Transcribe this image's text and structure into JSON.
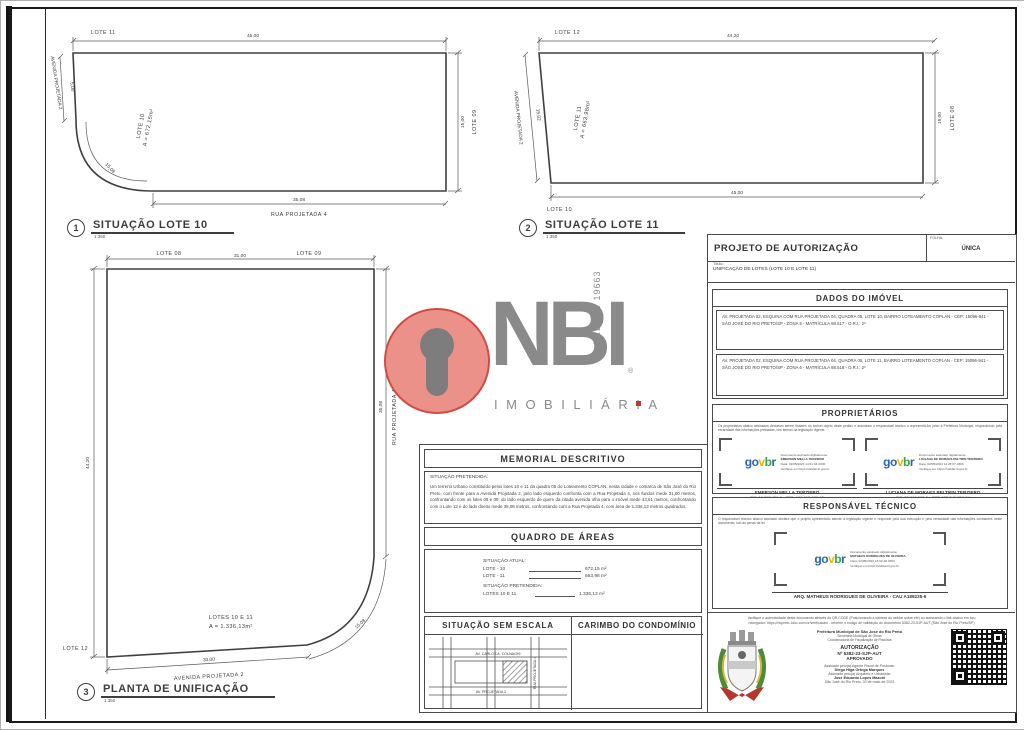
{
  "drawings": {
    "lote10": {
      "title_number": "1",
      "title": "SITUAÇÃO LOTE 10",
      "scale": "1:350",
      "top_label": "LOTE 11",
      "top_dim": "45,00",
      "left_street": "AVENIDA PROJETADA 2",
      "left_dim": "5,00",
      "curve_dim": "15,08",
      "inner_label": "LOTE 10",
      "inner_area": "A = 672,15m²",
      "right_label": "LOTE 09",
      "right_dim": "15,00",
      "bottom_dim": "35,08",
      "bottom_street": "RUA PROJETADA 4"
    },
    "lote11": {
      "title_number": "2",
      "title": "SITUAÇÃO LOTE 11",
      "scale": "1:350",
      "top_label": "LOTE 12",
      "top_dim": "44,20",
      "left_street": "AVENIDA PROJETADA 2",
      "left_dim": "15,02",
      "inner_label": "LOTE 11",
      "inner_area": "A = 663,98m²",
      "right_label": "LOTE 08",
      "right_dim": "15,00",
      "bottom_dim": "45,00",
      "bottom_label": "LOTE 10"
    },
    "unificacao": {
      "title_number": "3",
      "title": "PLANTA DE UNIFICAÇÃO",
      "scale": "1:350",
      "top_label_left": "LOTE 08",
      "top_label_right": "LOTE 09",
      "top_dim": "31,00",
      "left_dim": "44,20",
      "right_street": "RUA PROJETADA 4",
      "right_dim": "35,08",
      "curve_dim": "15,08",
      "inner_label": "LOTES 10 E 11",
      "inner_area": "A = 1.336,13m²",
      "left_label": "LOTE 12",
      "bottom_dim": "30,00",
      "bottom_street": "AVENIDA PROJETADA 2"
    }
  },
  "memorial": {
    "title": "MEMORIAL DESCRITIVO",
    "situation_label": "SITUAÇÃO PRETENDIDA:",
    "body": "Um terreno Urbano constituído pelos lotes 10 e 11 da quadra 05 do Loteamento COPLAN, nesta cidade e comarca de São José do Rio Preto, com frente para a Avenida Projetada 2, pelo lado esquerdo confronta com a Rua Projetada 4, nos fundos mede 31,00 metros, confrontando com os lotes 08 e 09; do lado esquerdo de quem da citada avenida olha para o imóvel mede 43,61 metros, confrontando com o Lote 12 e do lado direito mede 35,08 metros, confrontando com a Rua Projetada 4, com área de 1.336,13 metros quadrados."
  },
  "quadro": {
    "title": "QUADRO DE ÁREAS",
    "atual_label": "SITUAÇÃO ATUAL:",
    "rows": [
      {
        "label": "LOTE - 10",
        "value": "672,15 m²"
      },
      {
        "label": "LOTE - 11",
        "value": "663,98 m²"
      }
    ],
    "pretendida_label": "SITUAÇÃO PRETENDIDA:",
    "total_row": {
      "label": "LOTES 10 E 11",
      "value": "1.336,13 m²"
    }
  },
  "sem_escala": {
    "title": "SITUAÇÃO SEM ESCALA",
    "map": {
      "top_street": "AV. CARLOS A. COLNAGHI",
      "bottom_street": "AV. PROJETADA 2",
      "right_street": "RUA PROJETADA 4"
    }
  },
  "carimbo": {
    "title": "CARIMBO DO CONDOMÍNIO"
  },
  "projeto": {
    "title": "PROJETO DE AUTORIZAÇÃO",
    "folha_label": "FOLHA:",
    "folha_value": "ÚNICA",
    "titulo_label": "Título:",
    "titulo_value": "UNIFICAÇÃO DE LOTES (LOTE 10 E LOTE 11)"
  },
  "dados_imovel": {
    "title": "DADOS DO IMÓVEL",
    "lote10": "AV. PROJETADA 02, ESQUINA COM RUA PROJETADA 04, QUADRA 05, LOTE 10, BAIRRO LOTEAMENTO COPLAN - CEP: 15096-941 - SÃO JOSÉ DO RIO PRETO/SP - ZONA 6 - MATRÍCULA 88.517 - O.R.I.: 2º",
    "lote11": "AV. PROJETADA 02, ESQUINA COM RUA PROJETADA 04, QUADRA 05, LOTE 11, BAIRRO LOTEAMENTO COPLAN - CEP: 15096-941 - SÃO JOSÉ DO RIO PRETO/SP - ZONA 6 - MATRÍCULA 88.518 - O.R.I.: 2º"
  },
  "proprietarios": {
    "title": "PROPRIETÁRIOS",
    "disclaimer": "Os proprietários abaixo assinados declaram serem titulares do imóvel objeto deste pedido e autorizam o responsável técnico a representá-los junto à Prefeitura Municipal, respondendo pela veracidade das informações prestadas, nos termos da legislação vigente.",
    "govbr": {
      "g": "g",
      "o": "o",
      "v": "v",
      "b": "b",
      "r": "r"
    },
    "stamps": [
      {
        "line1": "Documento assinado digitalmente",
        "name": "EMERSON MELLA TERZIERO",
        "date": "Data: 02/05/2023 14:21:33-0300",
        "verify": "Verifique em https://validar.iti.gov.br",
        "display_name": "EMERSON MELLA TERZIERO",
        "doc": "RG: 18.017.481-9 - CPF: 109.413.178-92"
      },
      {
        "line1": "Documento assinado digitalmente",
        "name": "LUCIANA DE MORAES PELTRIN TERZIERO",
        "date": "Data: 02/05/2023 14:25:07-0300",
        "verify": "Verifique em https://validar.iti.gov.br",
        "display_name": "LUCIANA DE MORAES PELTRIN TERZIERO",
        "doc": "RG: 20.018.903-5 - CPF: 135.540.768-24"
      }
    ]
  },
  "responsavel": {
    "title": "RESPONSÁVEL TÉCNICO",
    "disclaimer": "O responsável técnico abaixo assinado declara que o projeto apresentado atende à legislação vigente e responde pela sua execução e pela veracidade das informações constantes neste documento, sob as penas da lei.",
    "stamp": {
      "line1": "Documento assinado digitalmente",
      "name": "MATHEUS RODRIGUES DE OLIVEIRA",
      "date": "Data: 02/05/2023 16:02:48-0300",
      "verify": "Verifique em https://validar.iti.gov.br"
    },
    "credential": "ARQ. MATHEUS RODRIGUES DE OLIVEIRA - CAU A189225-6"
  },
  "autorizacao": {
    "verify_line1": "Verifique a autenticidade deste documento através do QR CODE (Posicionando a câmera do celular sobre ele) ou acessando o link abaixo em seu",
    "verify_line2": "navegador: https://riopreto.1doc.com.br/verificacao/ - informe o código de validação do documento 5382-23-SJP-AUT (São José do Rio Preto/SP)",
    "org1": "Prefeitura Municipal de São José do Rio Preto",
    "org2": "Secretaria Municipal de Obras",
    "org3": "Coordenadoria de Fiscalização de Posturas",
    "stamp_title": "AUTORIZAÇÃO",
    "stamp_number": "Nº 5382-23-SJP-AUT",
    "stamp_status": "APROVADO",
    "signer1_label": "Assinado pelo(a) Agente Fiscal de Posturas:",
    "signer1": "Diego Higa Ortega Marques",
    "signer2_label": "Assinado pelo(a) Arquiteto e Urbanista:",
    "signer2": "José Eduardo Lopes Mazoni",
    "city_date": "São José do Rio Preto, 03 de maio de 2023"
  },
  "watermark": {
    "brand": "NBI",
    "subtitle": "IMOBILIÁRIA",
    "creci": "CRECI J 19663",
    "reg": "®"
  },
  "colors": {
    "watermark_red": "#cf4d45",
    "watermark_gray": "#8a8a8a",
    "govbr_blue": "#2864ae",
    "govbr_yellow": "#f0b400",
    "govbr_green": "#35a549"
  }
}
